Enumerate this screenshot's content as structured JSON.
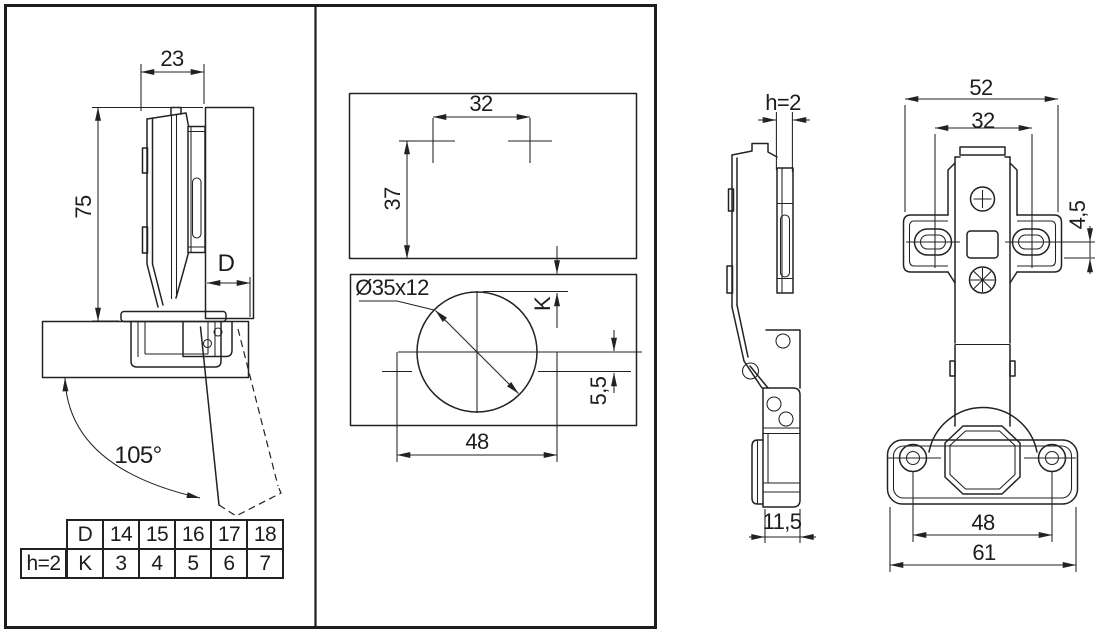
{
  "drawing": {
    "colors": {
      "line": "#222222",
      "background": "#ffffff"
    },
    "views": {
      "side_section": {
        "dims": {
          "arm_width": "23",
          "height": "75",
          "overlay": "D",
          "opening_angle": "105°"
        }
      },
      "drilling": {
        "dims": {
          "plate_screw_spacing": "32",
          "plate_offset": "37",
          "cup_bore": "Ø35x12",
          "cup_distance": "K",
          "screw_offset": "5,5",
          "cup_screw_spacing": "48"
        }
      },
      "side_profile": {
        "dims": {
          "plate_height": "h=2",
          "cup_depth": "11,5"
        }
      },
      "front": {
        "dims": {
          "arm_length": "52",
          "plate_screw_spacing": "32",
          "slot_offset": "4,5",
          "flange_screw_spacing": "48",
          "flange_width": "61"
        }
      }
    },
    "table": {
      "corner_label": "h=2",
      "row_d": {
        "label": "D",
        "values": [
          "14",
          "15",
          "16",
          "17",
          "18"
        ]
      },
      "row_k": {
        "label": "K",
        "values": [
          "3",
          "4",
          "5",
          "6",
          "7"
        ]
      }
    }
  }
}
